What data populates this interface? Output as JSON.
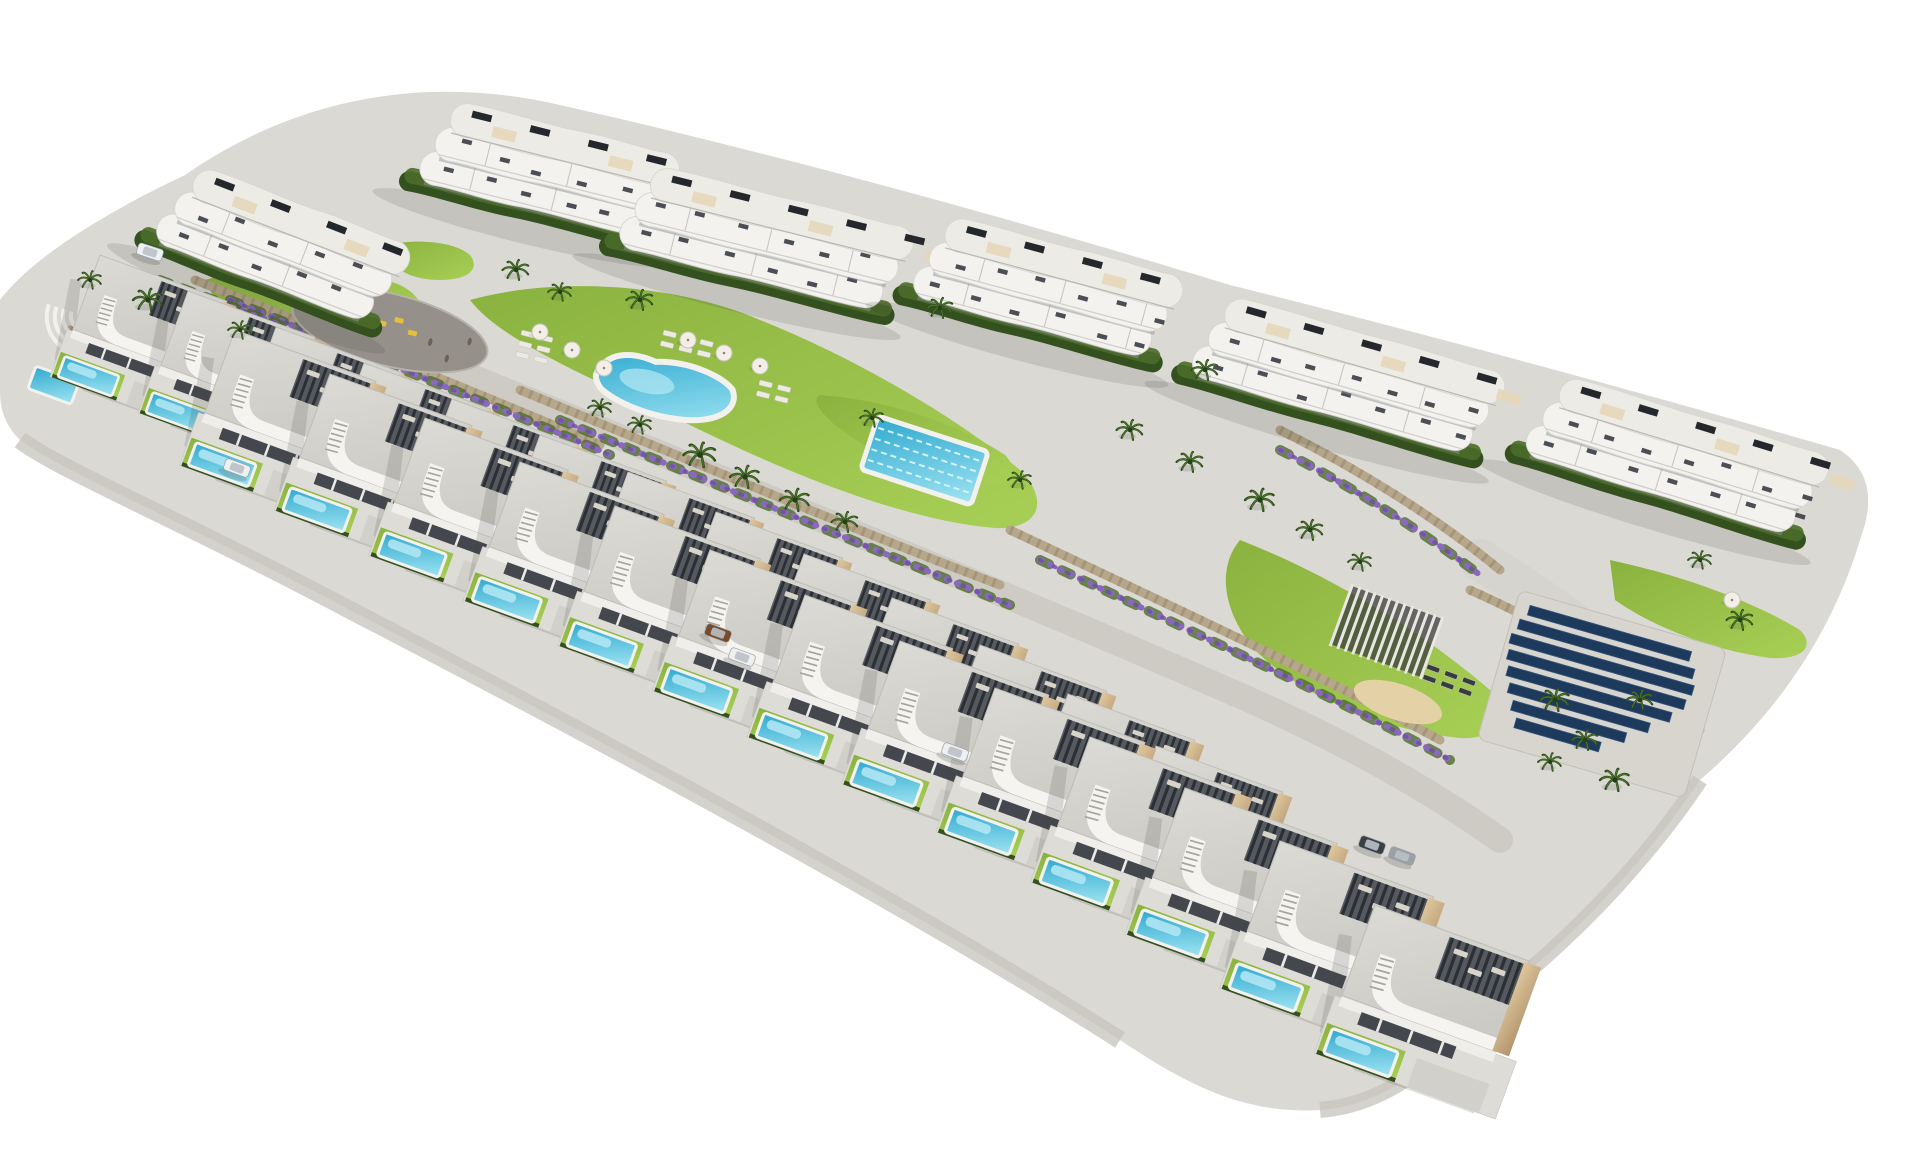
{
  "scene": {
    "title": "Aerial 3D architectural render of a hillside residential development: six white curved-balcony apartment buildings, two staircase rows of modern villas with private turquoise pools, communal freeform pool, lap pool, plaza with playground, gardens, palm trees, solar panel array",
    "canvas": {
      "width": 1920,
      "height": 1152
    },
    "background": "#ffffff",
    "palette": {
      "site": "#dbd9d3",
      "cliff": "#c6c3bb",
      "road": "#d6d4ce",
      "road2": "#cecbc5",
      "plaza": "#95918a",
      "lawnA": "#8ab23f",
      "lawnB": "#a8cf55",
      "hedge": "#33501e",
      "hedge2": "#4a6b28",
      "palmDark": "#2e4a1d",
      "palmLight": "#4e7a2b",
      "flower": "#8a68bd",
      "flowerDark": "#6d4fa0",
      "stone": "#b7a78a",
      "stoneDark": "#8f7f63",
      "bandWhite": "#f3f2ef",
      "bandEdge": "#d8d6d1",
      "roofBand": "#ecebe6",
      "roofUnit": "#24282c",
      "deckTan": "#e5d6b6",
      "furn": "#383c42",
      "slat": "#2c3035",
      "slatBase": "#555a60",
      "roofGravelA": "#dcdad5",
      "roofGravelB": "#c9c7c1",
      "beigeA": "#dfc79d",
      "beigeB": "#b3946c",
      "poolA": "#2fa9cf",
      "poolB": "#9fe4f2",
      "poolDeck": "#f2f1ed",
      "shimmer": "#b5e8f3",
      "sand": "#e4d1a6",
      "shadow": "#3c3e3c",
      "porch": "#44484e",
      "solarPanel": "#1d3a5c",
      "solarEdge": "#35567e",
      "solarPad": "#d7d5ce",
      "carWhite": "#eef0f2",
      "carBrown": "#7a4b2a",
      "carDark": "#3a3f45",
      "carGray": "#9aa0a6",
      "people": "#6b6258",
      "toy": "#e5bf3a"
    },
    "site": {
      "outline": "M 185,175 C 300,95 430,75 560,105 C 760,150 1000,215 1230,285 C 1450,340 1650,395 1840,450 C 1870,470 1875,500 1860,540 C 1830,640 1770,720 1700,780 C 1640,870 1560,950 1480,1010 C 1430,1070 1380,1105 1320,1110 C 1240,1115 1180,1080 1120,1040 C 900,900 600,740 350,610 C 180,520 60,470 20,440 C 5,425 0,410 0,390 L 0,300 C 30,260 100,215 185,175 Z",
      "cliff_left": "M 20,440 C 60,470 180,520 350,610 C 600,740 900,900 1120,1040",
      "cliff_right": "M 1700,780 C 1640,870 1560,950 1480,1010 C 1430,1070 1380,1105 1320,1110"
    },
    "roads": [
      {
        "d": "M 170,350 C 500,480 850,640 1150,790 C 1260,845 1350,900 1420,960",
        "width": 36,
        "key": "road"
      },
      {
        "d": "M 430,360 C 700,470 1000,590 1250,700 C 1350,745 1430,790 1500,840",
        "width": 26,
        "key": "road2"
      },
      {
        "d": "M 1480,560 C 1560,610 1620,655 1665,705",
        "width": 42,
        "key": "road"
      }
    ],
    "lawns": [
      "M 470,300 C 560,275 680,285 760,320 C 860,360 960,420 1020,470 C 1050,500 1040,530 995,528 C 900,520 780,470 680,420 C 590,378 500,340 470,300 Z",
      "M 1240,540 C 1330,575 1420,630 1490,690 C 1510,715 1500,740 1460,738 C 1380,730 1300,695 1255,650 C 1225,615 1215,570 1240,540 Z",
      "M 1610,560 C 1680,575 1750,600 1800,630 C 1815,645 1805,660 1770,658 C 1710,650 1650,625 1615,600 Z",
      "M 205,280 C 270,260 350,265 400,285 C 430,300 425,320 385,325 C 320,330 250,318 215,300 Z",
      "M 385,245 C 420,238 455,242 470,255 C 480,268 470,280 440,280 C 410,280 388,268 385,245 Z",
      "M 820,395 C 890,400 960,425 1005,455 C 1020,470 1012,488 980,484 C 920,475 865,450 835,425 C 818,410 812,400 820,395 Z"
    ],
    "walls": [
      "M 195,280 C 370,350 520,410 600,445",
      "M 520,390 C 700,465 880,540 1000,585",
      "M 1010,530 C 1180,610 1330,680 1440,740",
      "M 1280,430 C 1360,470 1440,520 1500,570",
      "M 1470,590 C 1560,630 1640,680 1700,730",
      "M 70,330 C 130,355 180,375 235,400"
    ],
    "flower_beds": [
      "M 230,300 C 390,365 530,420 610,455",
      "M 560,420 C 730,490 900,560 1010,605",
      "M 1040,560 C 1200,635 1340,700 1450,760",
      "M 1550,640 C 1600,665 1650,700 1690,735",
      "M 160,280 C 200,295 240,310 280,325",
      "M 1280,450 C 1350,485 1420,530 1480,575"
    ],
    "plaza": {
      "cx": 390,
      "cy": 330,
      "rx": 100,
      "ry": 36,
      "rot": 14,
      "playground": [
        [
          392,
          316
        ],
        [
          408,
          325
        ],
        [
          376,
          323
        ]
      ],
      "people": [
        [
          432,
          332
        ],
        [
          452,
          344
        ],
        [
          470,
          322
        ]
      ]
    },
    "main_pool": {
      "x": 605,
      "y": 345,
      "w": 140,
      "h": 58,
      "rot": 13
    },
    "lap_pool": {
      "x": 878,
      "y": 416,
      "w": 116,
      "h": 56,
      "rot": 18,
      "lanes": 4
    },
    "left_pool": {
      "x": 36,
      "y": 366,
      "w": 46,
      "h": 24,
      "rot": 20
    },
    "left_steps": {
      "x": 85,
      "y": 316,
      "rot": 18,
      "radii": [
        14,
        22,
        30,
        38
      ]
    },
    "pergola": {
      "x": 1352,
      "y": 586,
      "w": 96,
      "h": 62,
      "rot": 20,
      "bars": 12
    },
    "solar": {
      "pad": {
        "x": 1520,
        "y": 590,
        "w": 215,
        "h": 155,
        "rot": 16
      },
      "rows": [
        {
          "x": 14,
          "y": 12,
          "len": 168
        },
        {
          "x": 8,
          "y": 28,
          "len": 182
        },
        {
          "x": 4,
          "y": 44,
          "len": 190
        },
        {
          "x": 6,
          "y": 60,
          "len": 184
        },
        {
          "x": 10,
          "y": 76,
          "len": 170
        },
        {
          "x": 16,
          "y": 92,
          "len": 146
        },
        {
          "x": 24,
          "y": 108,
          "len": 118
        },
        {
          "x": 32,
          "y": 124,
          "len": 88
        }
      ]
    },
    "sand": {
      "cx": 1398,
      "cy": 702,
      "rx": 46,
      "ry": 18,
      "rot": 18
    },
    "beach_loungers": {
      "x": 1428,
      "y": 664,
      "rows": 2,
      "cols": 3,
      "rot": 20,
      "dark": true
    },
    "lounger_groups": [
      {
        "x": 522,
        "y": 330,
        "rows": 3,
        "cols": 2,
        "rot": 14,
        "dark": false
      },
      {
        "x": 664,
        "y": 330,
        "rows": 2,
        "cols": 3,
        "rot": 14,
        "dark": false
      },
      {
        "x": 760,
        "y": 380,
        "rows": 2,
        "cols": 2,
        "rot": 14,
        "dark": false
      }
    ],
    "parasols": [
      [
        540,
        332
      ],
      [
        572,
        350
      ],
      [
        604,
        368
      ],
      [
        688,
        340
      ],
      [
        724,
        353
      ],
      [
        760,
        366
      ],
      [
        1732,
        600
      ]
    ],
    "buildings": [
      {
        "x": 455,
        "y": 100,
        "w": 235,
        "floors": 3,
        "angle": 14
      },
      {
        "x": 200,
        "y": 165,
        "w": 230,
        "floors": 3,
        "angle": 21
      },
      {
        "x": 655,
        "y": 165,
        "w": 270,
        "floors": 3,
        "angle": 14
      },
      {
        "x": 950,
        "y": 215,
        "w": 245,
        "floors": 3,
        "angle": 15
      },
      {
        "x": 1230,
        "y": 295,
        "w": 290,
        "floors": 3,
        "angle": 16
      },
      {
        "x": 1565,
        "y": 375,
        "w": 280,
        "floors": 3,
        "angle": 17
      }
    ],
    "villas": {
      "angle": 20,
      "upper": {
        "scale": 0.9,
        "positions": [
          [
            100,
            255
          ],
          [
            188,
            291
          ],
          [
            276,
            327
          ],
          [
            364,
            363
          ],
          [
            452,
            399
          ],
          [
            540,
            435
          ],
          [
            628,
            472
          ],
          [
            716,
            512
          ],
          [
            804,
            554
          ],
          [
            892,
            598
          ],
          [
            980,
            645
          ],
          [
            1068,
            694
          ],
          [
            1156,
            746
          ]
        ]
      },
      "lower": {
        "scale_start": 1.0,
        "scale_step": 0.008,
        "positions": [
          [
            235,
            330
          ],
          [
            330,
            374
          ],
          [
            425,
            418
          ],
          [
            520,
            462
          ],
          [
            615,
            506
          ],
          [
            710,
            550
          ],
          [
            805,
            595
          ],
          [
            900,
            641
          ],
          [
            995,
            688
          ],
          [
            1090,
            737
          ],
          [
            1185,
            788
          ],
          [
            1280,
            841
          ],
          [
            1375,
            905
          ]
        ]
      }
    },
    "palms": [
      [
        148,
        300,
        1.0
      ],
      [
        240,
        330,
        0.8
      ],
      [
        90,
        280,
        0.8
      ],
      [
        516,
        270,
        0.9
      ],
      [
        560,
        292,
        0.8
      ],
      [
        640,
        300,
        0.9
      ],
      [
        700,
        455,
        1.1
      ],
      [
        745,
        477,
        1.0
      ],
      [
        795,
        500,
        1.0
      ],
      [
        845,
        522,
        0.9
      ],
      [
        640,
        425,
        0.8
      ],
      [
        600,
        408,
        0.8
      ],
      [
        940,
        308,
        0.9
      ],
      [
        1205,
        370,
        0.9
      ],
      [
        1130,
        430,
        0.9
      ],
      [
        1190,
        462,
        0.9
      ],
      [
        1260,
        500,
        1.0
      ],
      [
        1310,
        530,
        0.9
      ],
      [
        1360,
        562,
        0.8
      ],
      [
        1555,
        700,
        1.0
      ],
      [
        1585,
        740,
        0.9
      ],
      [
        1615,
        780,
        1.0
      ],
      [
        1550,
        762,
        0.8
      ],
      [
        1640,
        700,
        0.9
      ],
      [
        1740,
        620,
        0.9
      ],
      [
        1700,
        560,
        0.8
      ],
      [
        872,
        418,
        0.8
      ],
      [
        1020,
        480,
        0.8
      ]
    ],
    "cars": [
      {
        "x": 150,
        "y": 252,
        "rot": 18,
        "key": "carWhite"
      },
      {
        "x": 237,
        "y": 468,
        "rot": 20,
        "key": "carWhite"
      },
      {
        "x": 718,
        "y": 633,
        "rot": 20,
        "key": "carBrown"
      },
      {
        "x": 742,
        "y": 657,
        "rot": 20,
        "key": "carWhite"
      },
      {
        "x": 955,
        "y": 752,
        "rot": 20,
        "key": "carWhite"
      },
      {
        "x": 1372,
        "y": 845,
        "rot": 20,
        "key": "carDark"
      },
      {
        "x": 1402,
        "y": 856,
        "rot": 20,
        "key": "carGray"
      }
    ]
  }
}
